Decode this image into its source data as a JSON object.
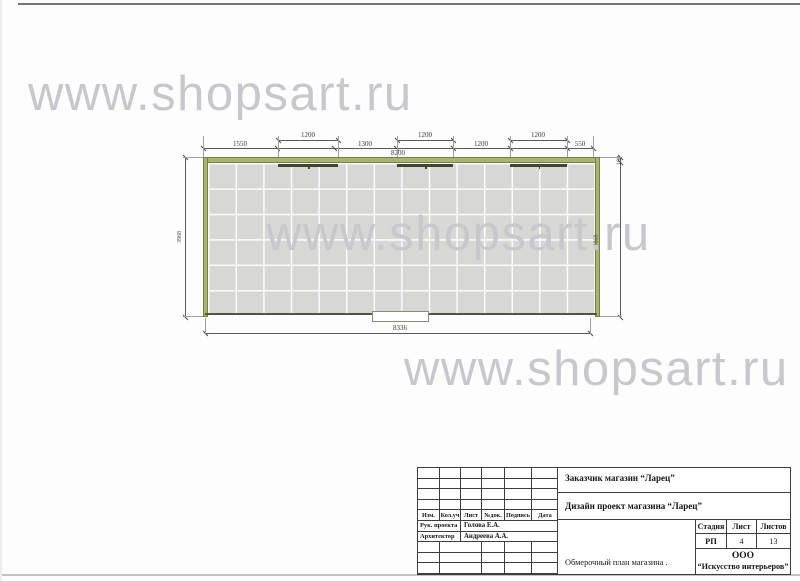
{
  "watermark": {
    "text": "www.shopsart.ru"
  },
  "plan": {
    "dimensions": {
      "windows": [
        "1200",
        "1200",
        "1200"
      ],
      "chain": [
        "1550",
        "1300",
        "1200",
        "550"
      ],
      "top_total": "8200",
      "bottom_total": "8336",
      "left_height": "3968",
      "right_interior_height": "3868",
      "wall_thickness": "100"
    }
  },
  "title_block": {
    "customer": "Заказчик магазин “Ларец”",
    "project": "Дизайн проект магазина “Ларец”",
    "revision_columns": [
      "Изм.",
      "Кол.уч",
      "Лист",
      "№док.",
      "Подпись",
      "Дата"
    ],
    "roles": [
      {
        "label": "Рук. проекта",
        "name": "Голова Е.А."
      },
      {
        "label": "Архитектор",
        "name": "Андреева А.А."
      }
    ],
    "stage": {
      "headers": [
        "Стадия",
        "Лист",
        "Листов"
      ],
      "values": [
        "РП",
        "4",
        "13"
      ]
    },
    "drawing_title": "Обмерочный план магазина .",
    "company": {
      "line1": "ООО",
      "line2": "“Искусство интерьеров”"
    }
  }
}
